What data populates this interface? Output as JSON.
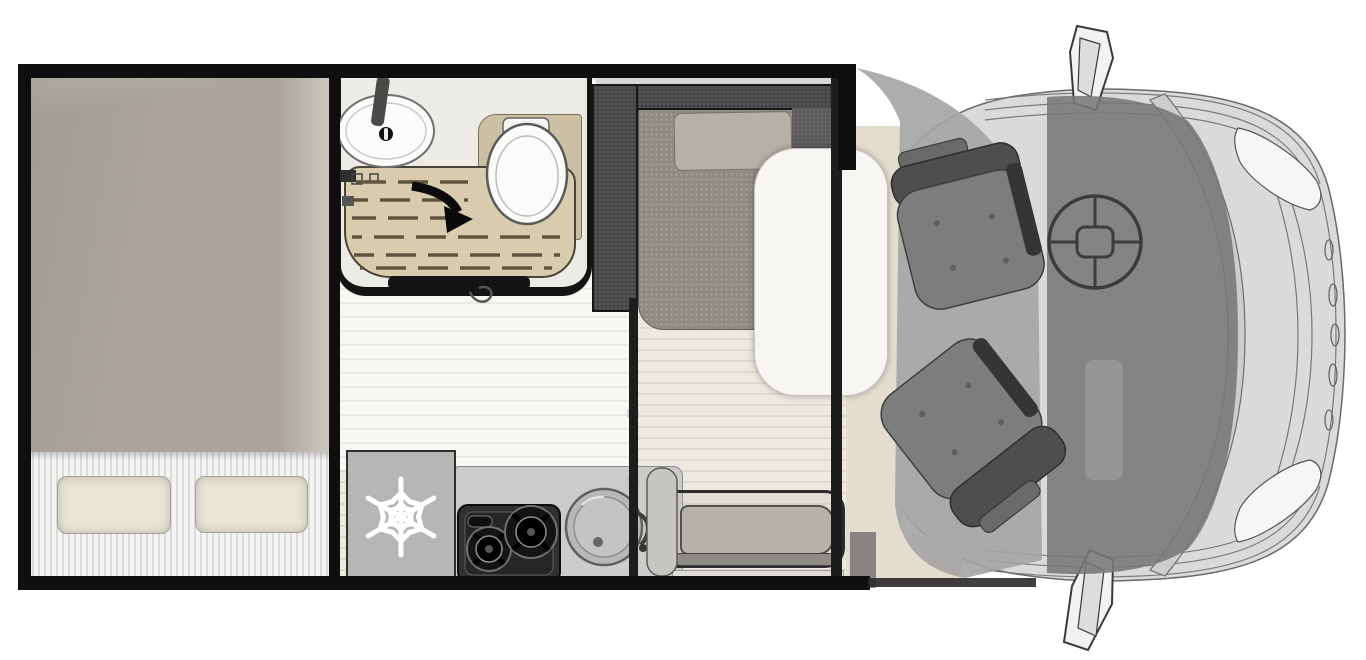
{
  "meta": {
    "title": "Motorhome floor plan — top view with cab",
    "type": "floor-plan-diagram",
    "width_px": 1366,
    "height_px": 660,
    "visible_text": []
  },
  "areas": {
    "bedroom": {
      "label": "rear transverse bed",
      "features": [
        "mattress",
        "ribbed bedding band",
        "pillow-left",
        "pillow-right"
      ]
    },
    "bathroom": {
      "label": "washroom",
      "features": [
        "oval washbasin with tap",
        "fold-away shower tray with duckboard slats",
        "swivel arrow marking",
        "toilet with lid"
      ]
    },
    "kitchen": {
      "label": "kitchenette",
      "features": [
        "refrigerator with snowflake icon",
        "two-burner gas hob",
        "round sink with tap",
        "worktop"
      ]
    },
    "dinette": {
      "label": "L-lounge dinette",
      "features": [
        "upholstered backrest",
        "seat cushion",
        "headrest cushion",
        "pedestal table"
      ]
    },
    "entrance": {
      "label": "side bench seat at entry door",
      "features": [
        "bench cushion",
        "bench rail",
        "entry step"
      ]
    },
    "cab": {
      "label": "driver cab",
      "features": [
        "driver swivel seat",
        "passenger swivel seat",
        "steering wheel",
        "windscreen",
        "wing mirror top",
        "wing mirror bottom",
        "headlight upper",
        "headlight lower",
        "front grille"
      ]
    }
  },
  "icons": [
    {
      "name": "snowflake-icon",
      "meaning": "refrigerator"
    },
    {
      "name": "swivel-arrow-icon",
      "meaning": "folding shower tray direction"
    },
    {
      "name": "steering-wheel-icon",
      "meaning": "driver position"
    }
  ],
  "colors": {
    "wall": "#0f0f0f",
    "floor_wood": "#e7e2d6",
    "floor_light": "#f1efe9",
    "mattress": "#aba59b",
    "bedding": "#f4f4f3",
    "pillow": "#e9e5d8",
    "shower_tray": "#d9cbae",
    "toilet_panel": "#cdbfa3",
    "fixture_white": "#fbfbfa",
    "counter": "#cbcbc9",
    "fridge": "#b6b6b5",
    "hob": "#30302f",
    "dinette_backrest": "#474747",
    "dinette_seat": "#908c84",
    "dinette_cushion": "#b6b1a6",
    "table": "#f7f6f3",
    "bench": "#b5b2aa",
    "cab_seat": "#7d7d7d",
    "cab_overlay": "#a4a4a4",
    "windscreen_glass": "#787878",
    "vehicle_body": "#dadada",
    "line_art": "#5a5a5a",
    "snowflake": "#ffffff",
    "arrow": "#0a0a0a"
  }
}
